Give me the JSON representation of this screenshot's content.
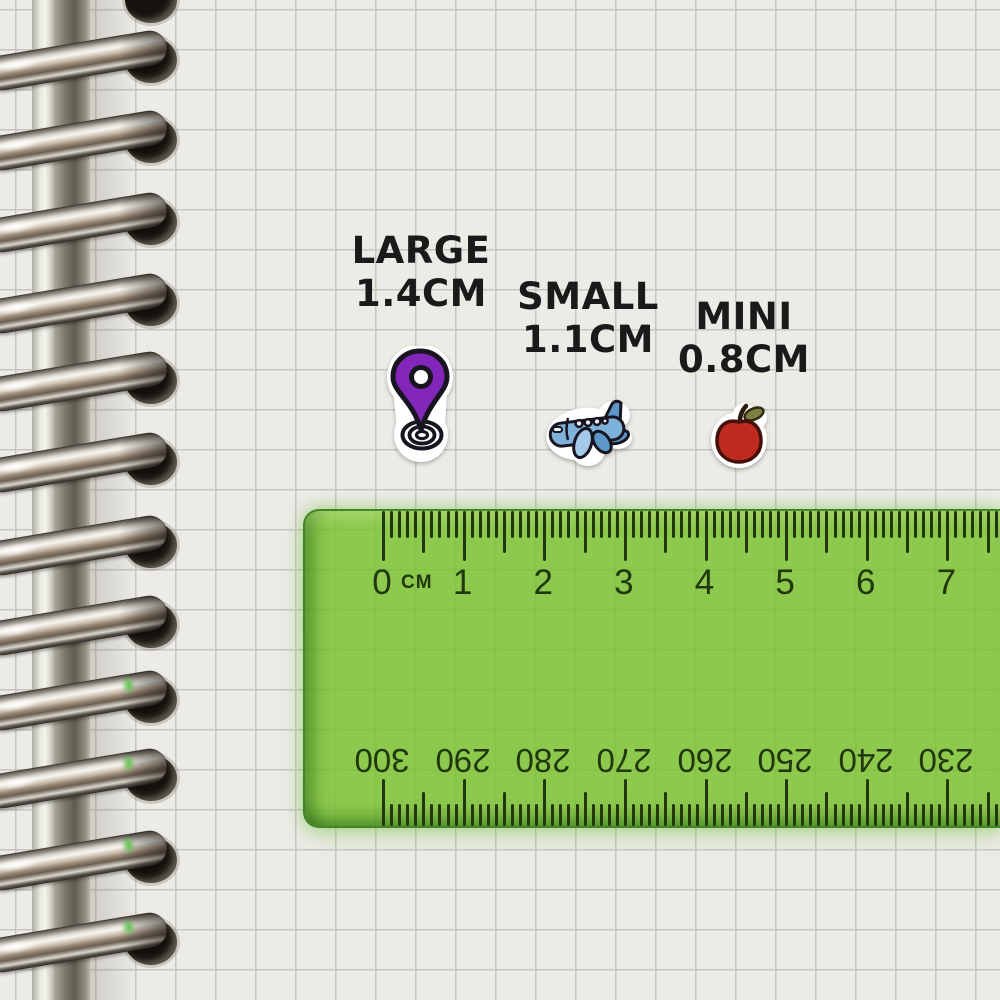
{
  "stickers": [
    {
      "id": "location-pin",
      "icon": "map-pin-icon",
      "size_label": "LARGE",
      "size_value": "1.4CM"
    },
    {
      "id": "airplane",
      "icon": "airplane-icon",
      "size_label": "SMALL",
      "size_value": "1.1CM"
    },
    {
      "id": "apple",
      "icon": "apple-icon",
      "size_label": "MINI",
      "size_value": "0.8CM"
    }
  ],
  "ruler": {
    "unit_label": "CM",
    "top_scale_numbers": [
      "0",
      "1",
      "2",
      "3",
      "4",
      "5",
      "6",
      "7"
    ],
    "bottom_scale_numbers": [
      "300",
      "290",
      "280",
      "270",
      "260",
      "250",
      "240",
      "230"
    ]
  },
  "notebook": {
    "ring_count": 12
  },
  "colors": {
    "paper": "#ecebe6",
    "grid_line": "#c6c6c1",
    "label_ink": "#1a1a1a",
    "ruler_green": "rgba(116,192,39,0.8)",
    "ruler_ink": "#21380f",
    "pin_purple": "#8326ba",
    "plane_blue": "#7fb2da",
    "plane_blue_light": "#a5c9e8",
    "plane_blue_dark": "#5d97c8",
    "apple_red": "#be2a1e",
    "leaf_green": "#7b7f42",
    "outline_ink": "#181420"
  }
}
